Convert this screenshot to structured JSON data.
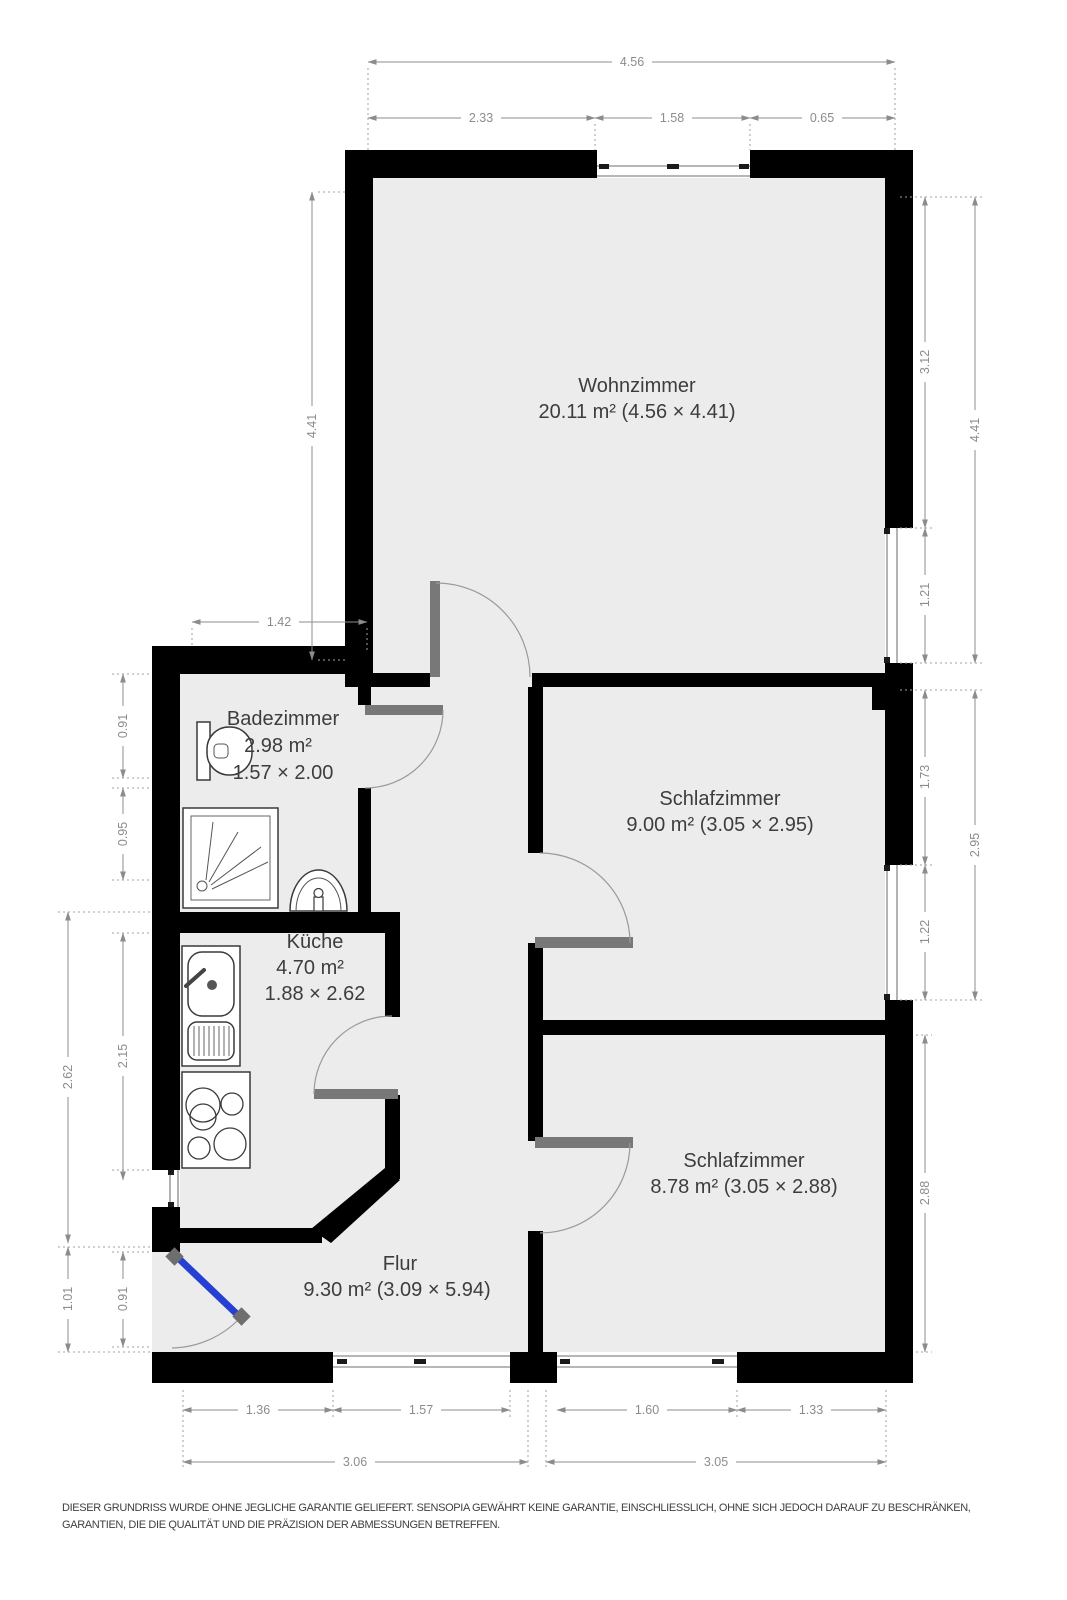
{
  "colors": {
    "wall": "#000000",
    "floor": "#ececec",
    "door_leaf": "#787878",
    "entrance_door": "#2640d4",
    "dimension": "#8c8c8c",
    "label": "#3d3d3d"
  },
  "rooms": {
    "wohnzimmer": {
      "name": "Wohnzimmer",
      "area": "20.11 m² (4.56 × 4.41)"
    },
    "badezimmer": {
      "name": "Badezimmer",
      "area": "2.98 m²",
      "size": "1.57 × 2.00"
    },
    "schlafzimmer_mitte": {
      "name": "Schlafzimmer",
      "area": "9.00 m² (3.05 × 2.95)"
    },
    "kueche": {
      "name": "Küche",
      "area": "4.70 m²",
      "size": "1.88 × 2.62"
    },
    "schlafzimmer_unten": {
      "name": "Schlafzimmer",
      "area": "8.78 m² (3.05 × 2.88)"
    },
    "flur": {
      "name": "Flur",
      "area": "9.30 m² (3.09 × 5.94)"
    }
  },
  "dimensions": {
    "top_total": "4.56",
    "top_left": "2.33",
    "top_window": "1.58",
    "top_right": "0.65",
    "left_wohnzimmer": "4.41",
    "left_bad_width": "1.42",
    "left_bad_upper": "0.91",
    "left_bad_lower": "0.95",
    "left_kueche_outer": "2.62",
    "left_kueche_inner": "2.15",
    "left_entry_outer": "1.01",
    "left_entry_door": "0.91",
    "right_wall_upper": "3.12",
    "right_window_wohnzimmer": "1.21",
    "right_wohnzimmer_total": "4.41",
    "right_wall_mid": "1.73",
    "right_window_schlafzimmer": "1.22",
    "right_schlafzimmer_total": "2.95",
    "right_schlafzimmer_unten": "2.88",
    "bottom_flur_wall": "1.36",
    "bottom_flur_window": "1.57",
    "bottom_schlaf_window": "1.60",
    "bottom_schlaf_wall": "1.33",
    "bottom_left_total": "3.06",
    "bottom_right_total": "3.05"
  },
  "disclaimer": "DIESER GRUNDRISS WURDE OHNE JEGLICHE GARANTIE GELIEFERT. SENSOPIA GEWÄHRT KEINE GARANTIE, EINSCHLIESSLICH, OHNE SICH JEDOCH DARAUF ZU BESCHRÄNKEN, GARANTIEN, DIE DIE QUALITÄT UND DIE PRÄZISION DER ABMESSUNGEN BETREFFEN."
}
